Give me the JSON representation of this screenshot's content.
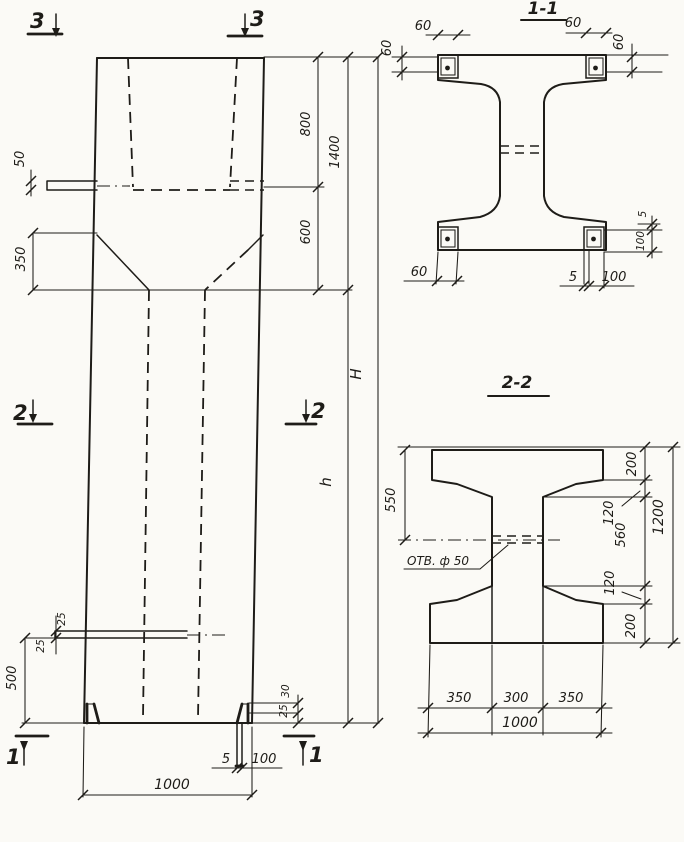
{
  "meta": {
    "background": "#fbfaf6",
    "ink": "#1e1c18",
    "drawing_type": "reinforced concrete column working drawing"
  },
  "elevation": {
    "marker_3_left": "3",
    "marker_3_right": "3",
    "marker_2_left": "2",
    "marker_2_right": "2",
    "marker_1_left": "1",
    "marker_1_right": "1",
    "dims": {
      "plate_offset": "50",
      "taper_height": "350",
      "top_segment": "800",
      "top_total": "1400",
      "taper_segment": "600",
      "total_height": "H",
      "shaft_height": "h",
      "hole_offset_top": "25",
      "hole_offset_bottom": "25",
      "hole_to_base": "500",
      "corner_detail_top": "30",
      "corner_detail_bottom": "25",
      "tab_thickness": "5",
      "tab_length": "100",
      "base_width": "1000"
    }
  },
  "section11": {
    "title": "1-1",
    "dims": {
      "plate_tl_width": "60",
      "plate_tl_height": "60",
      "plate_tr_width": "60",
      "plate_tr_height": "60",
      "plate_bl_width": "60",
      "tab_thickness": "5",
      "tab_width": "100",
      "right_gap": "5",
      "right_plate": "100"
    }
  },
  "section22": {
    "title": "2-2",
    "hole_label": "ОТВ. ф 50",
    "dims": {
      "top_to_hole": "550",
      "flange_top": "200",
      "taper_top": "120",
      "web_clear": "560",
      "taper_bottom": "120",
      "flange_bottom": "200",
      "total_height": "1200",
      "flange_left": "350",
      "web_width": "300",
      "flange_right": "350",
      "total_width": "1000"
    }
  }
}
